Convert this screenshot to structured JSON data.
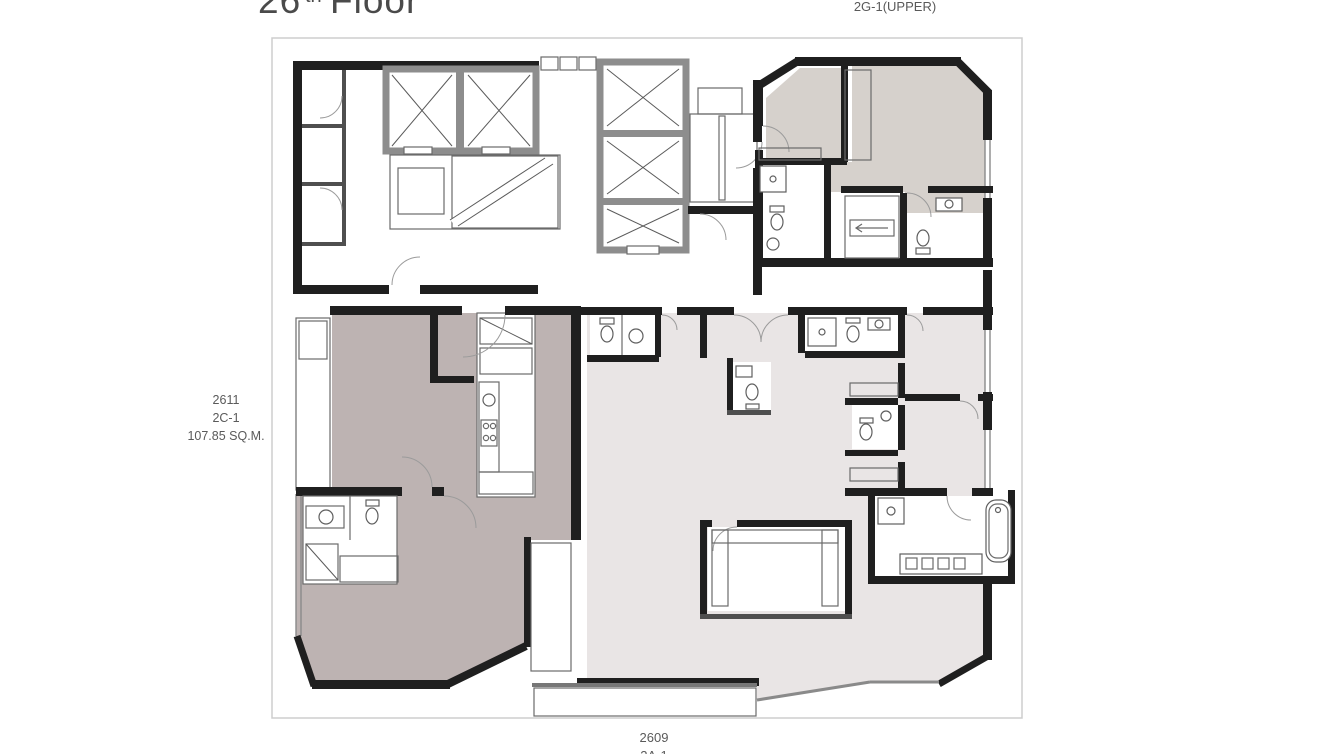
{
  "title": {
    "number": "26",
    "superscript": "th",
    "word": "Floor"
  },
  "units": {
    "top_right": {
      "label": "2G-1(UPPER)"
    },
    "left": {
      "number": "2611",
      "type": "2C-1",
      "area": "107.85 SQ.M."
    },
    "bottom": {
      "number": "2609",
      "type_partial": "2A-1"
    }
  },
  "plan_features": {
    "core": [
      "elevator-bank-left-2-shafts",
      "elevator-bank-right-3-shafts",
      "main-staircase",
      "secondary-staircase",
      "service-rooms"
    ],
    "unit_top_right": [
      "duplex-upper-level",
      "two-internal-staircases",
      "two-bathrooms",
      "wardrobe"
    ],
    "unit_left": [
      "living-dining",
      "kitchen",
      "bedroom",
      "bathroom",
      "side-balcony"
    ],
    "unit_bottom": [
      "living-dining",
      "three-bathrooms",
      "bedrooms",
      "walk-in-closet",
      "master-bath-with-tub",
      "tiled-balcony"
    ]
  },
  "colors": {
    "wall": "#1f1f1f",
    "core_wall": "#8d8d8d",
    "unit_top_right_fill": "#d6d1cc",
    "unit_left_fill": "#bdb3b2",
    "unit_bottom_fill": "#e9e5e5",
    "boundary": "#cdcdcd",
    "title_text": "#4a4a4a",
    "label_text": "#5a5a5a",
    "balcony_grid": "#b8b8b8"
  }
}
